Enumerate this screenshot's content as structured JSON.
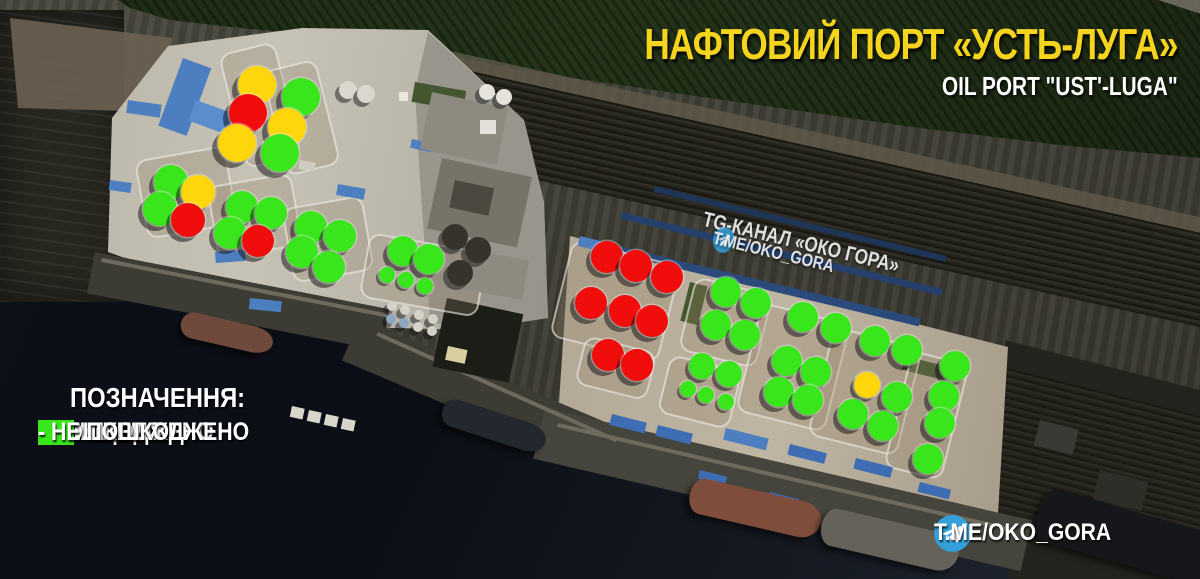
{
  "header": {
    "title_uk": "НАФТОВИЙ ПОРТ «УСТЬ-ЛУГА»",
    "title_en": "OIL PORT \"UST'-LUGA\""
  },
  "watermark": {
    "line1": "TG-КАНАЛ «ОКО ГОРА»",
    "line2": "T.ME/OKO_GORA",
    "icon": "telegram-icon"
  },
  "footer": {
    "handle": "T.ME/OKO_GORA",
    "icon": "telegram-icon"
  },
  "legend": {
    "heading": "ПОЗНАЧЕННЯ:",
    "items": [
      {
        "status": "destroyed",
        "color": "#f20d0d",
        "label": "- ЗНИЩЕНО"
      },
      {
        "status": "damaged",
        "color": "#ffd60b",
        "label": "- ПОШКОДЖЕНО"
      },
      {
        "status": "intact",
        "color": "#39e61c",
        "label": "- НЕ ПОШКОДЖЕНО"
      }
    ]
  },
  "colors": {
    "telegram_blue": "#34a0d9",
    "title_yellow": "#f4d41d"
  },
  "chart_data": {
    "type": "map-markers",
    "title": "Damage assessment of oil storage tanks, oil port Ust'-Luga",
    "status_colors": {
      "destroyed": "#f20d0d",
      "damaged": "#ffd60b",
      "intact": "#39e61c"
    },
    "counts": {
      "destroyed": 11,
      "damaged": 5,
      "intact": 40,
      "total": 56
    },
    "markers": [
      {
        "x": 257,
        "y": 85,
        "r": 19,
        "status": "damaged"
      },
      {
        "x": 248,
        "y": 113,
        "r": 19,
        "status": "destroyed"
      },
      {
        "x": 237,
        "y": 143,
        "r": 19,
        "status": "damaged"
      },
      {
        "x": 301,
        "y": 97,
        "r": 19,
        "status": "intact"
      },
      {
        "x": 287,
        "y": 127,
        "r": 19,
        "status": "damaged"
      },
      {
        "x": 280,
        "y": 153,
        "r": 19,
        "status": "intact"
      },
      {
        "x": 171,
        "y": 182,
        "r": 17,
        "status": "intact"
      },
      {
        "x": 198,
        "y": 192,
        "r": 17,
        "status": "damaged"
      },
      {
        "x": 160,
        "y": 209,
        "r": 17,
        "status": "intact"
      },
      {
        "x": 188,
        "y": 220,
        "r": 17,
        "status": "destroyed"
      },
      {
        "x": 242,
        "y": 207,
        "r": 16,
        "status": "intact"
      },
      {
        "x": 271,
        "y": 213,
        "r": 16,
        "status": "intact"
      },
      {
        "x": 230,
        "y": 233,
        "r": 16,
        "status": "intact"
      },
      {
        "x": 258,
        "y": 241,
        "r": 16,
        "status": "destroyed"
      },
      {
        "x": 311,
        "y": 227,
        "r": 16,
        "status": "intact"
      },
      {
        "x": 340,
        "y": 236,
        "r": 16,
        "status": "intact"
      },
      {
        "x": 302,
        "y": 252,
        "r": 16,
        "status": "intact"
      },
      {
        "x": 329,
        "y": 267,
        "r": 16,
        "status": "intact"
      },
      {
        "x": 403,
        "y": 251,
        "r": 15,
        "status": "intact"
      },
      {
        "x": 429,
        "y": 259,
        "r": 15,
        "status": "intact"
      },
      {
        "x": 387,
        "y": 275,
        "r": 8,
        "status": "intact"
      },
      {
        "x": 406,
        "y": 280,
        "r": 8,
        "status": "intact"
      },
      {
        "x": 425,
        "y": 286,
        "r": 8,
        "status": "intact"
      },
      {
        "x": 607,
        "y": 257,
        "r": 16,
        "status": "destroyed"
      },
      {
        "x": 636,
        "y": 266,
        "r": 16,
        "status": "destroyed"
      },
      {
        "x": 667,
        "y": 277,
        "r": 16,
        "status": "destroyed"
      },
      {
        "x": 591,
        "y": 303,
        "r": 16,
        "status": "destroyed"
      },
      {
        "x": 625,
        "y": 311,
        "r": 16,
        "status": "destroyed"
      },
      {
        "x": 652,
        "y": 321,
        "r": 16,
        "status": "destroyed"
      },
      {
        "x": 608,
        "y": 355,
        "r": 16,
        "status": "destroyed"
      },
      {
        "x": 637,
        "y": 365,
        "r": 16,
        "status": "destroyed"
      },
      {
        "x": 726,
        "y": 292,
        "r": 15,
        "status": "intact"
      },
      {
        "x": 756,
        "y": 303,
        "r": 15,
        "status": "intact"
      },
      {
        "x": 716,
        "y": 325,
        "r": 15,
        "status": "intact"
      },
      {
        "x": 745,
        "y": 335,
        "r": 15,
        "status": "intact"
      },
      {
        "x": 702,
        "y": 366,
        "r": 13,
        "status": "intact"
      },
      {
        "x": 729,
        "y": 374,
        "r": 13,
        "status": "intact"
      },
      {
        "x": 688,
        "y": 389,
        "r": 8,
        "status": "intact"
      },
      {
        "x": 706,
        "y": 395,
        "r": 8,
        "status": "intact"
      },
      {
        "x": 726,
        "y": 402,
        "r": 8,
        "status": "intact"
      },
      {
        "x": 803,
        "y": 317,
        "r": 15,
        "status": "intact"
      },
      {
        "x": 836,
        "y": 328,
        "r": 15,
        "status": "intact"
      },
      {
        "x": 787,
        "y": 361,
        "r": 15,
        "status": "intact"
      },
      {
        "x": 816,
        "y": 372,
        "r": 15,
        "status": "intact"
      },
      {
        "x": 779,
        "y": 392,
        "r": 15,
        "status": "intact"
      },
      {
        "x": 808,
        "y": 400,
        "r": 15,
        "status": "intact"
      },
      {
        "x": 875,
        "y": 341,
        "r": 15,
        "status": "intact"
      },
      {
        "x": 907,
        "y": 350,
        "r": 15,
        "status": "intact"
      },
      {
        "x": 867,
        "y": 385,
        "r": 13,
        "status": "damaged"
      },
      {
        "x": 897,
        "y": 397,
        "r": 15,
        "status": "intact"
      },
      {
        "x": 853,
        "y": 414,
        "r": 15,
        "status": "intact"
      },
      {
        "x": 883,
        "y": 426,
        "r": 15,
        "status": "intact"
      },
      {
        "x": 955,
        "y": 366,
        "r": 15,
        "status": "intact"
      },
      {
        "x": 944,
        "y": 396,
        "r": 15,
        "status": "intact"
      },
      {
        "x": 940,
        "y": 423,
        "r": 15,
        "status": "intact"
      },
      {
        "x": 928,
        "y": 459,
        "r": 15,
        "status": "intact"
      }
    ]
  }
}
